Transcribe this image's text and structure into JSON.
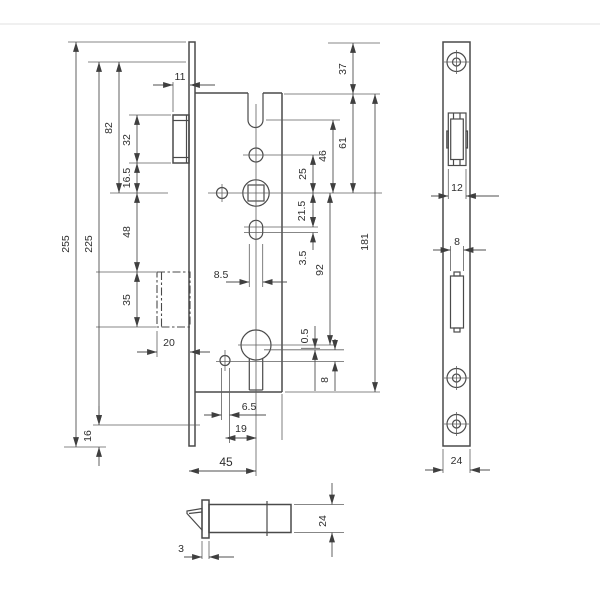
{
  "drawing": {
    "subject": "mortise-lock-technical-drawing",
    "front_view": {
      "dims": {
        "overall_length": "255",
        "screw_distance": "225",
        "top_to_spindle": "82",
        "latch_height": "32",
        "latch_to_spindle": "16.5",
        "spindle_to_box": "48",
        "box_height": "35",
        "bolt_width": "20",
        "bottom_margin": "16",
        "latch_projection": "11",
        "top_offset": "37",
        "body_top_to_spindle": "61",
        "notch_to_spindle": "46",
        "hole_to_spindle": "25",
        "spindle_to_slot": "21.5",
        "slot_play": "3.5",
        "spindle_to_cylinder": "92",
        "body_height": "181",
        "slot_width": "8.5",
        "offset_small": "0.5",
        "line_gap": "8",
        "screw_hole_dia": "6.5",
        "screw_to_axis": "19",
        "backset": "45"
      }
    },
    "faceplate_view": {
      "dims": {
        "latch_opening_width": "12",
        "bolt_opening_width": "8",
        "plate_width": "24"
      }
    },
    "side_view": {
      "dims": {
        "case_depth": "24",
        "plate_thickness": "3"
      }
    }
  }
}
